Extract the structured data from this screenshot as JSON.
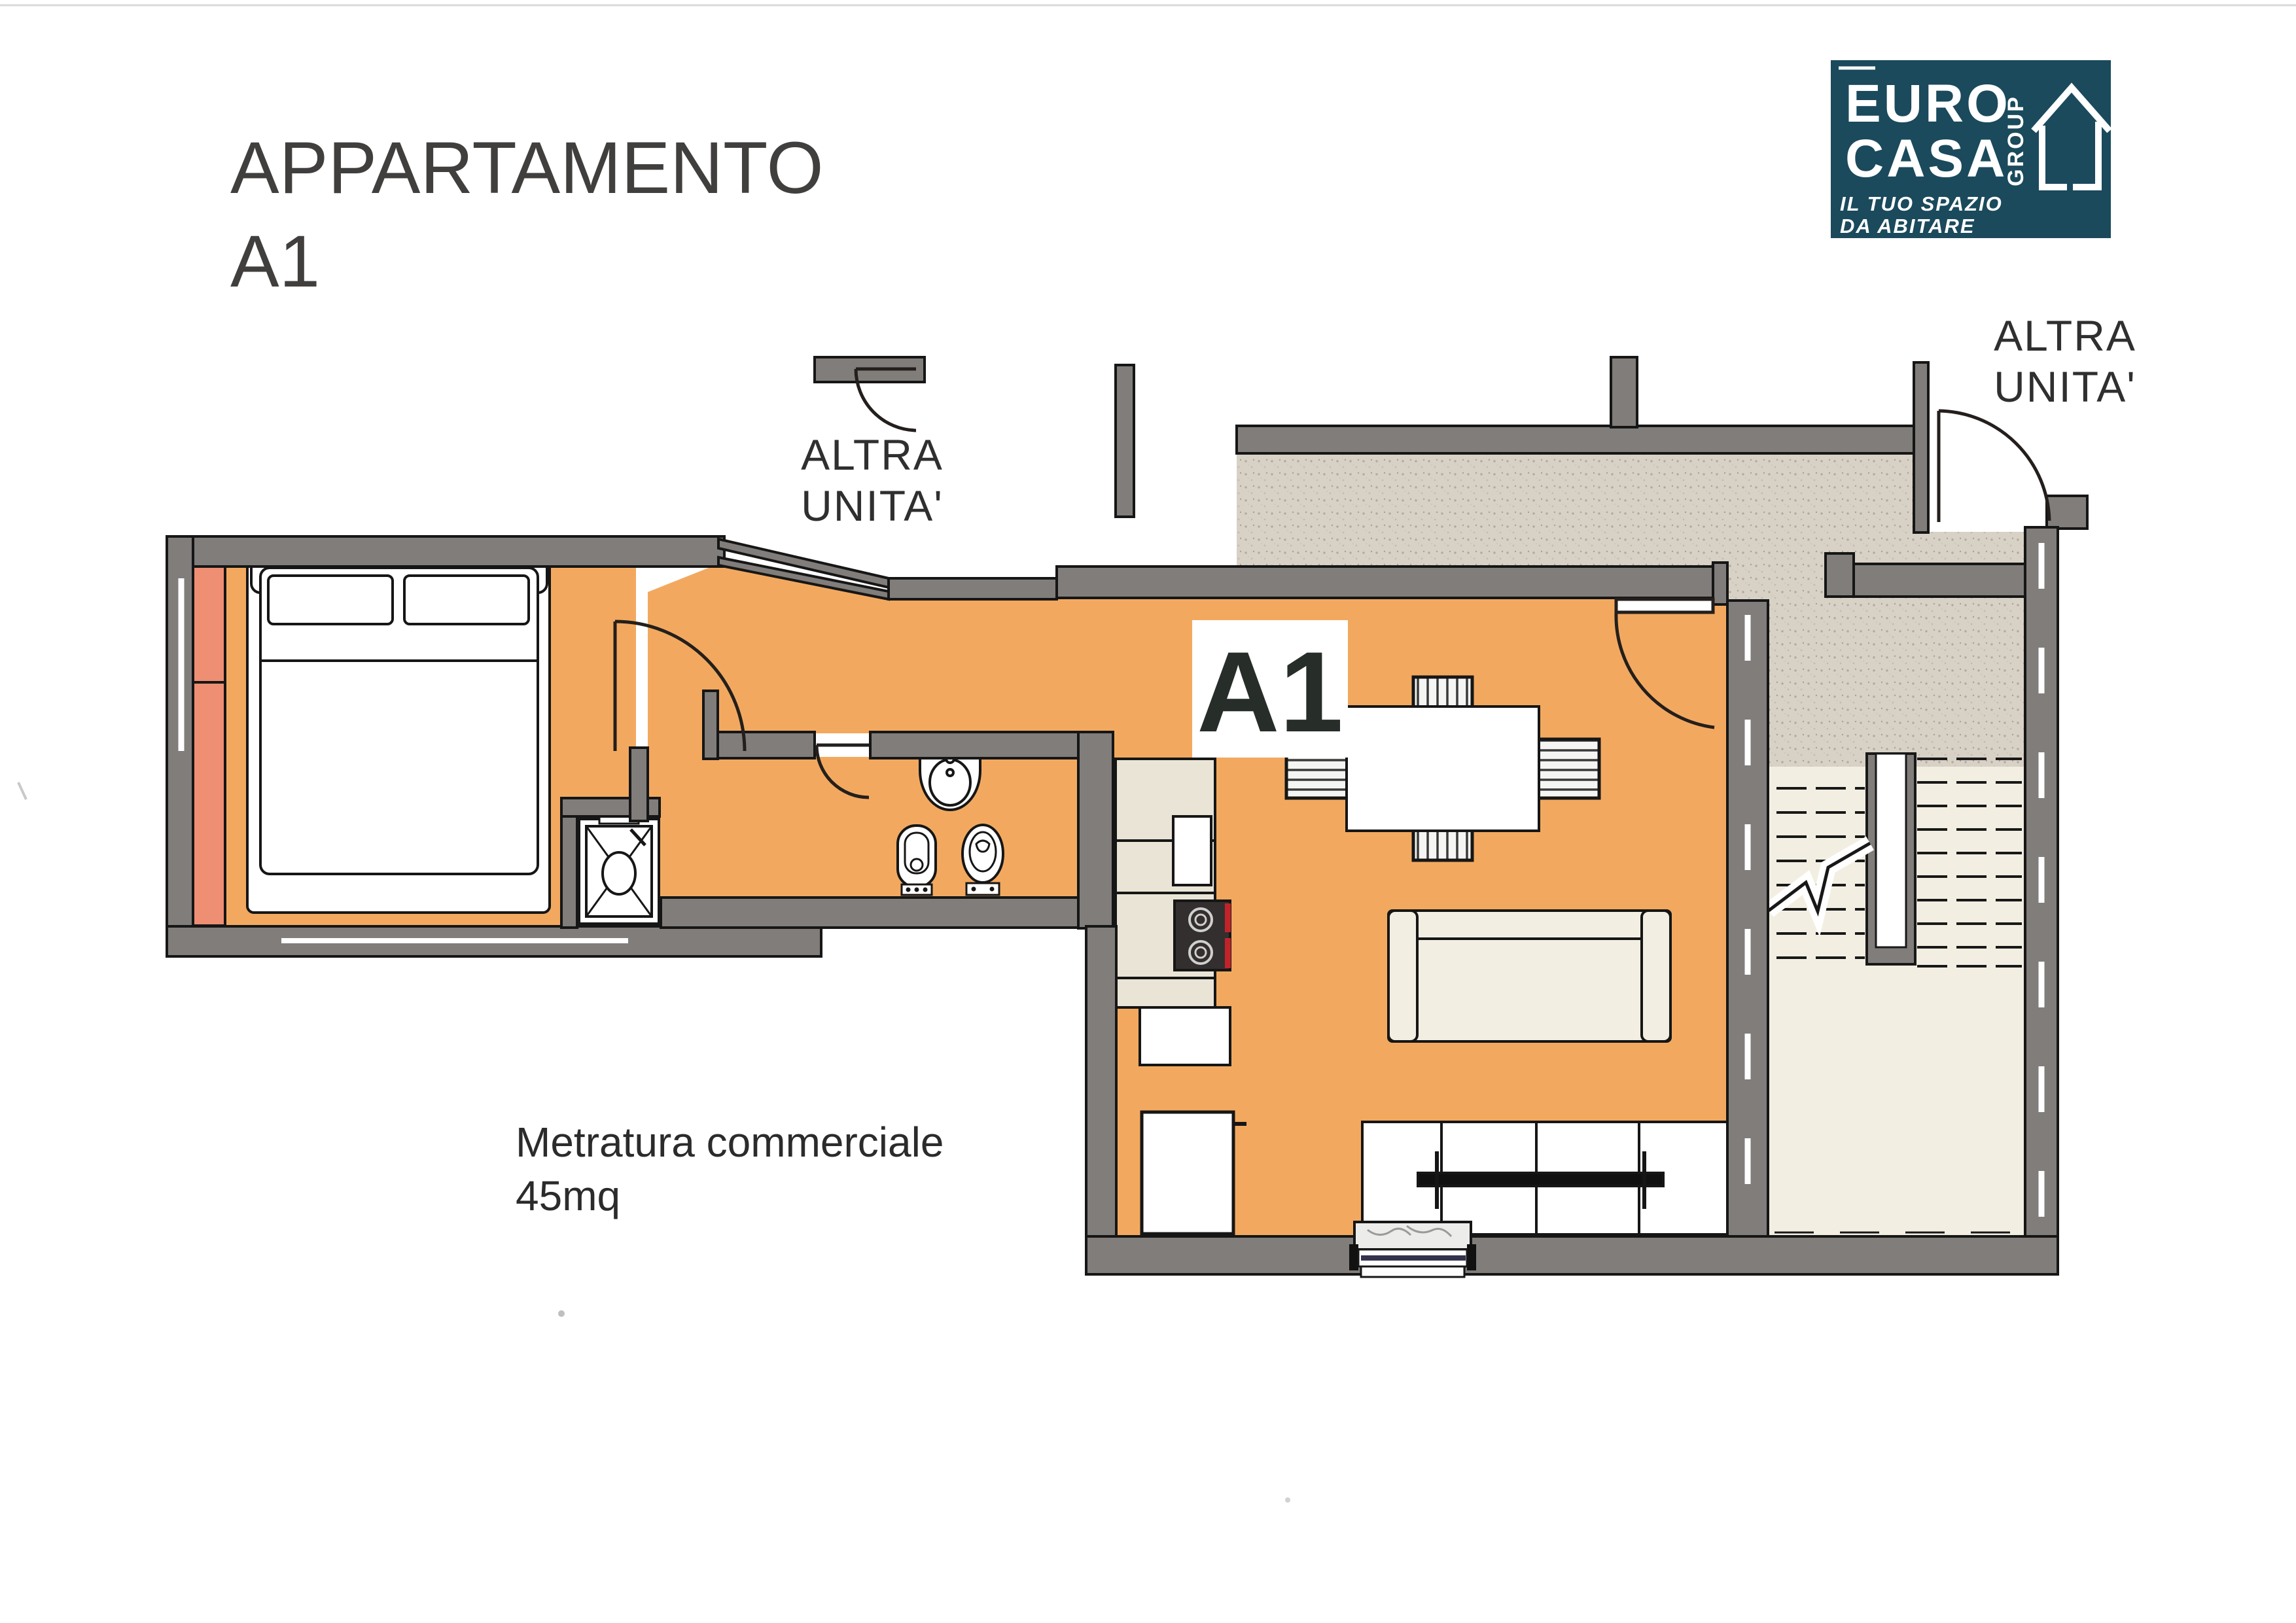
{
  "document": {
    "title_line1": "APPARTAMENTO",
    "title_line2": "A1",
    "area_label_line1": "Metratura commerciale",
    "area_label_line2": "45mq"
  },
  "plan": {
    "unit_badge": "A1",
    "other_unit_top": {
      "line1": "ALTRA",
      "line2": "UNITA'"
    },
    "other_unit_right": {
      "line1": "ALTRA",
      "line2": "UNITA'"
    }
  },
  "logo": {
    "word1": "EURO",
    "word2": "CASA",
    "word3": "GROUP",
    "tagline1": "IL TUO SPAZIO",
    "tagline2": "DA ABITARE",
    "bg": "#1a4a5c",
    "fg": "#ffffff"
  },
  "colors": {
    "wall": "#807d7a",
    "floor": "#f2a95f",
    "wardrobe": "#ee8e72",
    "corridor_base": "#d8d1c6",
    "corridor_dot": "#b3a99c",
    "cream": "#f2efe2",
    "counter": "#e9e4d6",
    "stove": "#332f2e",
    "accent_red": "#c2232b",
    "ink": "#1a1a1a",
    "text": "#3c3a39"
  }
}
